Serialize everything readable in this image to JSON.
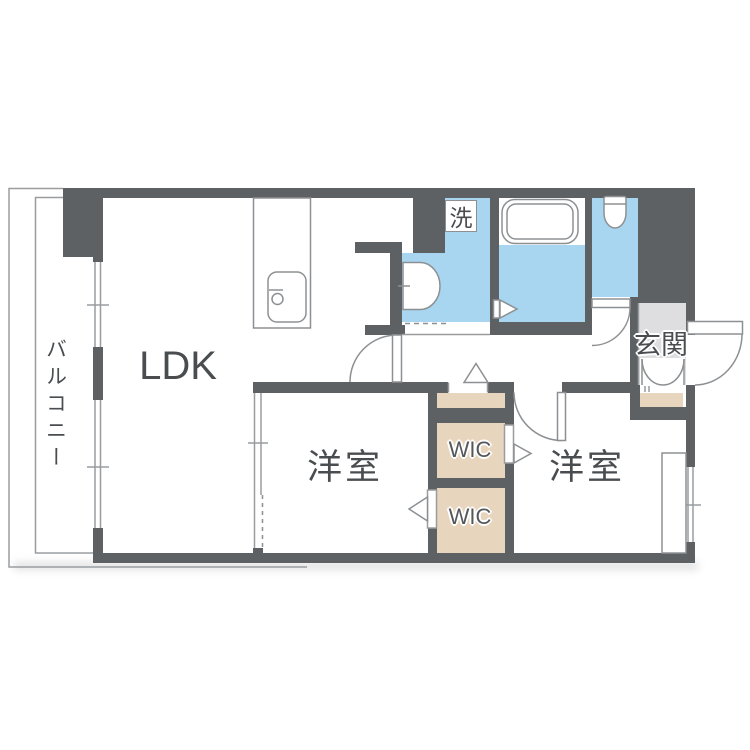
{
  "plan": {
    "type": "apartment-floor-plan",
    "labels": {
      "balcony": "バルコニー",
      "ldk": "LDK",
      "bedroom_left": "洋室",
      "bedroom_right": "洋室",
      "wic_top": "WIC",
      "wic_bottom": "WIC",
      "entrance": "玄関",
      "laundry": "洗"
    },
    "colors": {
      "wall": "#5e6164",
      "water": "#a8d5f0",
      "closet": "#e8d5bd",
      "entry": "#dedee0",
      "line": "#8d9093",
      "text": "#4a4d50",
      "bg": "#ffffff"
    }
  }
}
